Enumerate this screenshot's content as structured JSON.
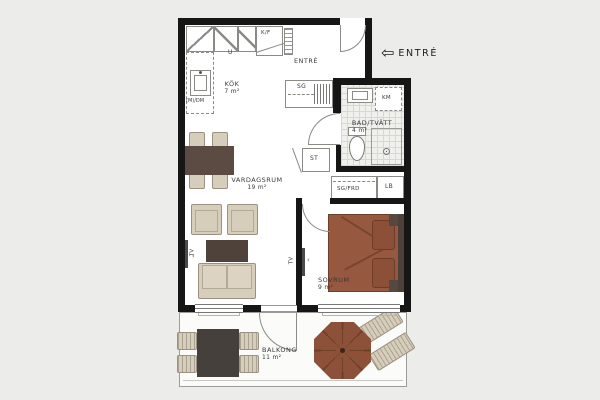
{
  "rooms": {
    "kitchen": {
      "name": "KÖK",
      "area": "7 m²"
    },
    "entry_hall": {
      "name": "ENTRÉ",
      "area": ""
    },
    "bathroom": {
      "name": "BAD/TVÄTT",
      "area": "4 m²"
    },
    "living_room": {
      "name": "VARDAGSRUM",
      "area": "19 m²"
    },
    "bedroom": {
      "name": "SOVRUM",
      "area": "9 m²"
    },
    "balcony": {
      "name": "BALKONG",
      "area": "11 m²"
    }
  },
  "storage": {
    "hall_wardrobe": "SG",
    "cleaning_closet": "ST",
    "sliding_wardrobe": "SG/FRD",
    "linen_cabinet": "LB"
  },
  "appliances": {
    "oven": "U",
    "fridge_freezer": "K/F",
    "micro_dishwasher": "(M)/DM",
    "washing_machine": "KM"
  },
  "outlets": {
    "tv_living_room": "TV",
    "tv_bedroom": "TV"
  },
  "entry_sign": {
    "label": "ENTRÉ",
    "arrow_icon": "⇦"
  },
  "colors": {
    "background": "#ECECEA",
    "walls": "#161616",
    "wood_furniture": "#5B4B43",
    "bed": "#96583F",
    "upholstery": "#D6CDBB",
    "parasol": "#8C5138"
  }
}
